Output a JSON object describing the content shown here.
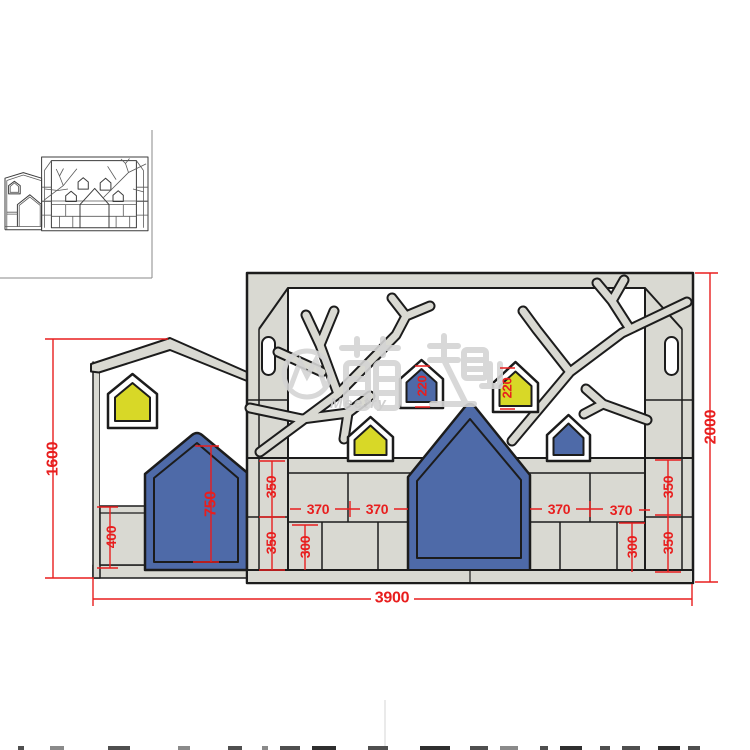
{
  "dims": {
    "total_width": "3900",
    "left_unit_height": "1600",
    "right_unit_height": "2000",
    "left_base_cabinet_height": "400",
    "left_door_height": "750",
    "hanging_house_left": "220",
    "hanging_house_right": "220",
    "cell_370": [
      "370",
      "370",
      "370",
      "370"
    ],
    "cell_350": [
      "350",
      "350",
      "350",
      "350"
    ],
    "cell_300": [
      "300",
      "300"
    ]
  },
  "watermark": {
    "cjk": "萌趣",
    "latin": "Meetry"
  },
  "colors": {
    "outline": "#1c1c1c",
    "panel": "#d9d9d2",
    "blue": "#4e6aa8",
    "yellow": "#d8d827",
    "dim_red": "#e81e1e",
    "watermark": "#d4d4d4"
  }
}
